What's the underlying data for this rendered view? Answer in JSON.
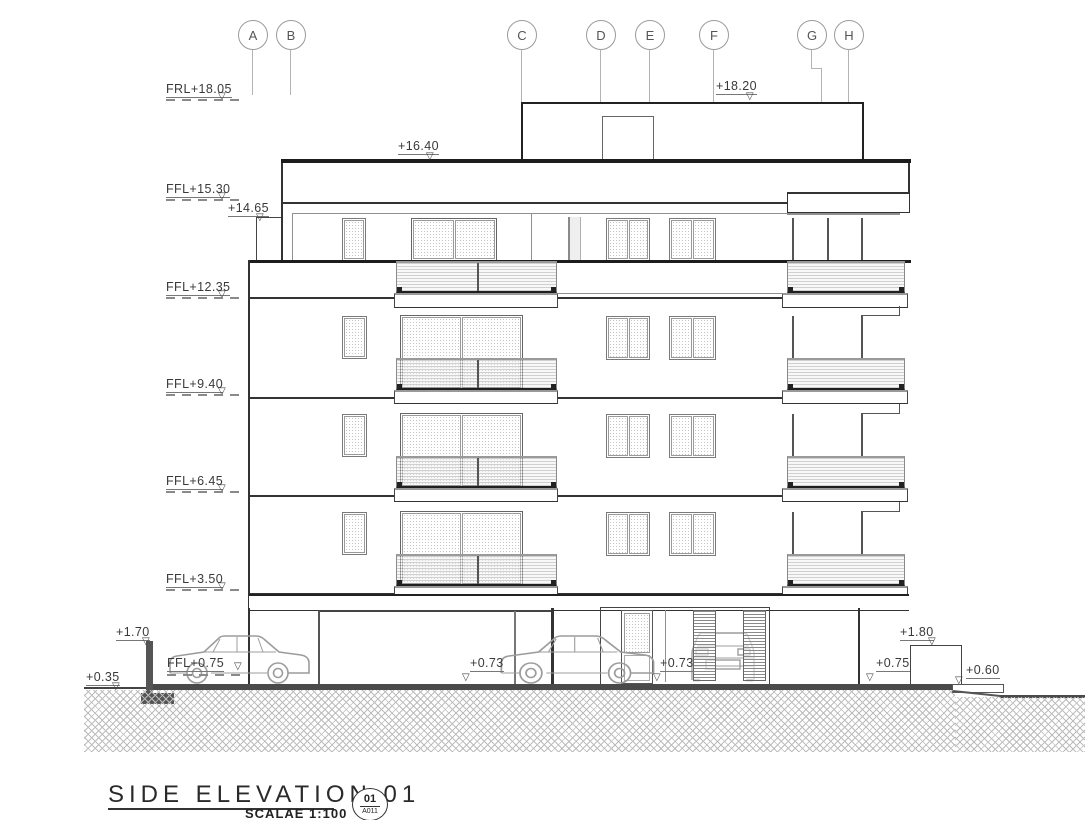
{
  "drawing": {
    "grid_labels": [
      "A",
      "B",
      "C",
      "D",
      "E",
      "F",
      "G",
      "H"
    ],
    "levels": [
      "FRL+18.05",
      "FFL+15.30",
      "FFL+12.35",
      "FFL+9.40",
      "FFL+6.45",
      "FFL+3.50"
    ],
    "spots": {
      "parapet_top": "+18.20",
      "roof": "+16.40",
      "terrace_parapet": "+14.65",
      "retaining_wall_top": "+1.70",
      "ground_left": "+0.35",
      "garage_floor": "FFL+0.75",
      "pavement_a": "+0.73",
      "pavement_b": "+0.73",
      "side_wall_top": "+1.80",
      "pavement_right": "+0.75",
      "ground_right": "+0.60"
    },
    "titleblock": {
      "title": "SIDE ELEVATION 01",
      "scale_label": "SCALAE 1:100",
      "detail_number": "01",
      "sheet_number": "A011"
    },
    "palette": {
      "ink": "#333333",
      "grid": "#b3b3b3",
      "earth": "#4a4a4a"
    },
    "icons": {
      "level_arrow": "▽"
    }
  }
}
